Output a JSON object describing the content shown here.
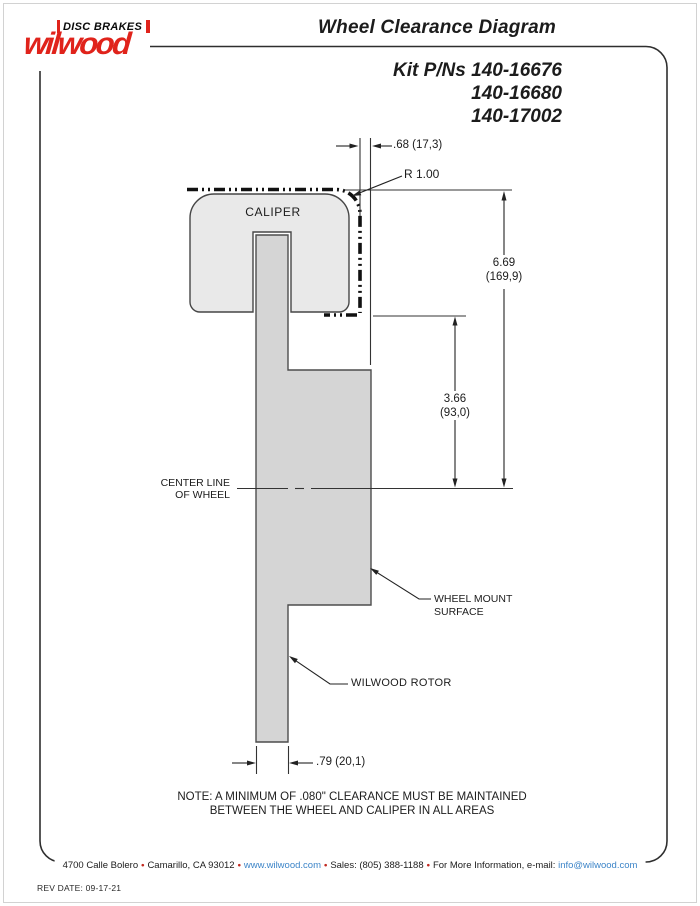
{
  "header": {
    "logo": {
      "disc_brakes": "DISC BRAKES",
      "wilwood": "wilwood"
    },
    "title": "Wheel Clearance Diagram",
    "kit_lines": [
      "Kit P/Ns 140-16676",
      "140-16680",
      "140-17002"
    ]
  },
  "diagram": {
    "caliper_label": "CALIPER",
    "centerline_label_1": "CENTER LINE",
    "centerline_label_2": "OF WHEEL",
    "wheel_mount_label_1": "WHEEL MOUNT",
    "wheel_mount_label_2": "SURFACE",
    "rotor_label": "WILWOOD ROTOR",
    "dims": {
      "gap": ".68 (17,3)",
      "radius": "R 1.00",
      "height_in": "6.69",
      "height_mm": "(169,9)",
      "offset_in": "3.66",
      "offset_mm": "(93,0)",
      "rotor_width": ".79 (20,1)"
    },
    "note_line_1": "NOTE: A MINIMUM OF .080\" CLEARANCE MUST BE MAINTAINED",
    "note_line_2": "BETWEEN THE WHEEL AND CALIPER IN ALL AREAS"
  },
  "footer": {
    "address": "4700 Calle Bolero",
    "city": "Camarillo, CA 93012",
    "website": "www.wilwood.com",
    "sales": "Sales: (805) 388-1188",
    "more_info": "For More Information, e-mail:",
    "email": "info@wilwood.com",
    "separator": "•",
    "rev_date": "REV DATE:  09-17-21"
  },
  "colors": {
    "logo_red": "#e0231b",
    "link_blue": "#3d85c8",
    "bullet_red": "#c22a21",
    "caliper_fill": "#e9e9e9",
    "rotor_fill": "#d5d5d5",
    "line": "#333333"
  }
}
